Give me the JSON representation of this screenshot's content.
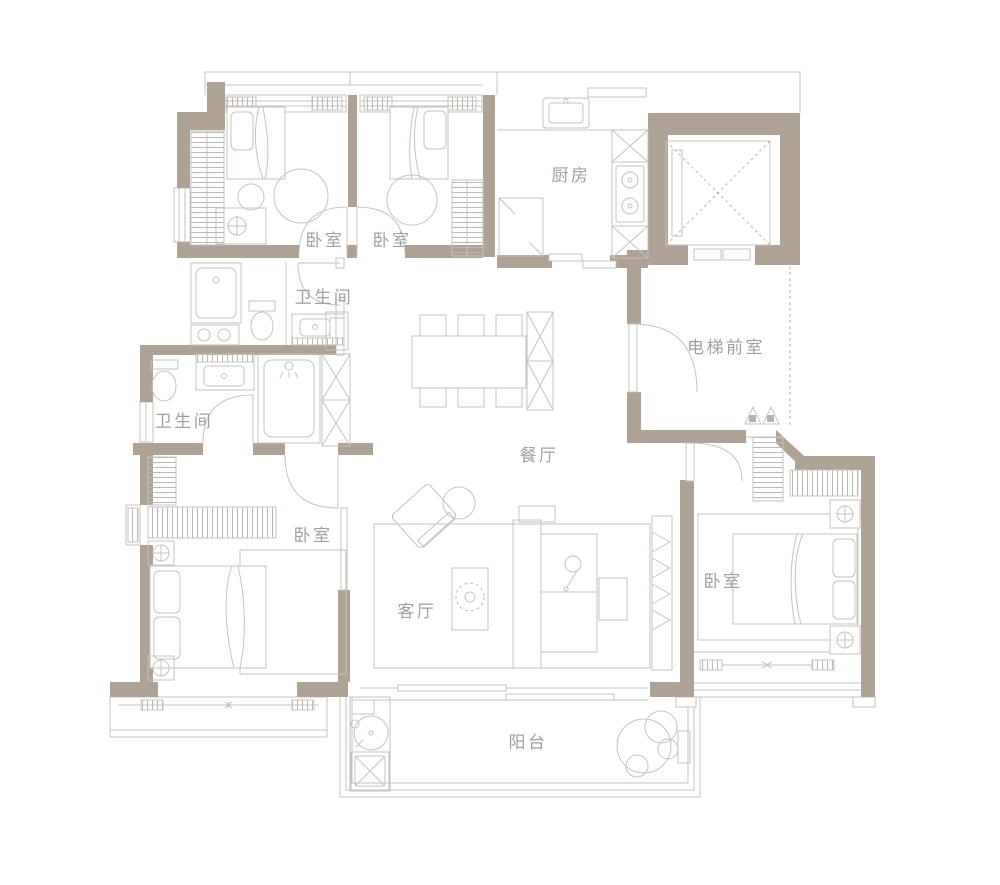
{
  "colors": {
    "wall": "#aea294",
    "line": "#c6c3be",
    "hatch": "#bab7b2",
    "label_text": "#a2a09c",
    "background": "#ffffff"
  },
  "rooms": [
    {
      "id": "bedroom-top-left",
      "label": "卧室"
    },
    {
      "id": "bedroom-top-middle",
      "label": "卧室"
    },
    {
      "id": "kitchen",
      "label": "厨房"
    },
    {
      "id": "bathroom-upper",
      "label": "卫生间"
    },
    {
      "id": "elevator-lobby",
      "label": "电梯前室"
    },
    {
      "id": "bathroom-lower",
      "label": "卫生间"
    },
    {
      "id": "dining-room",
      "label": "餐厅"
    },
    {
      "id": "bedroom-left",
      "label": "卧室"
    },
    {
      "id": "living-room",
      "label": "客厅"
    },
    {
      "id": "bedroom-right",
      "label": "卧室"
    },
    {
      "id": "balcony",
      "label": "阳台"
    }
  ]
}
